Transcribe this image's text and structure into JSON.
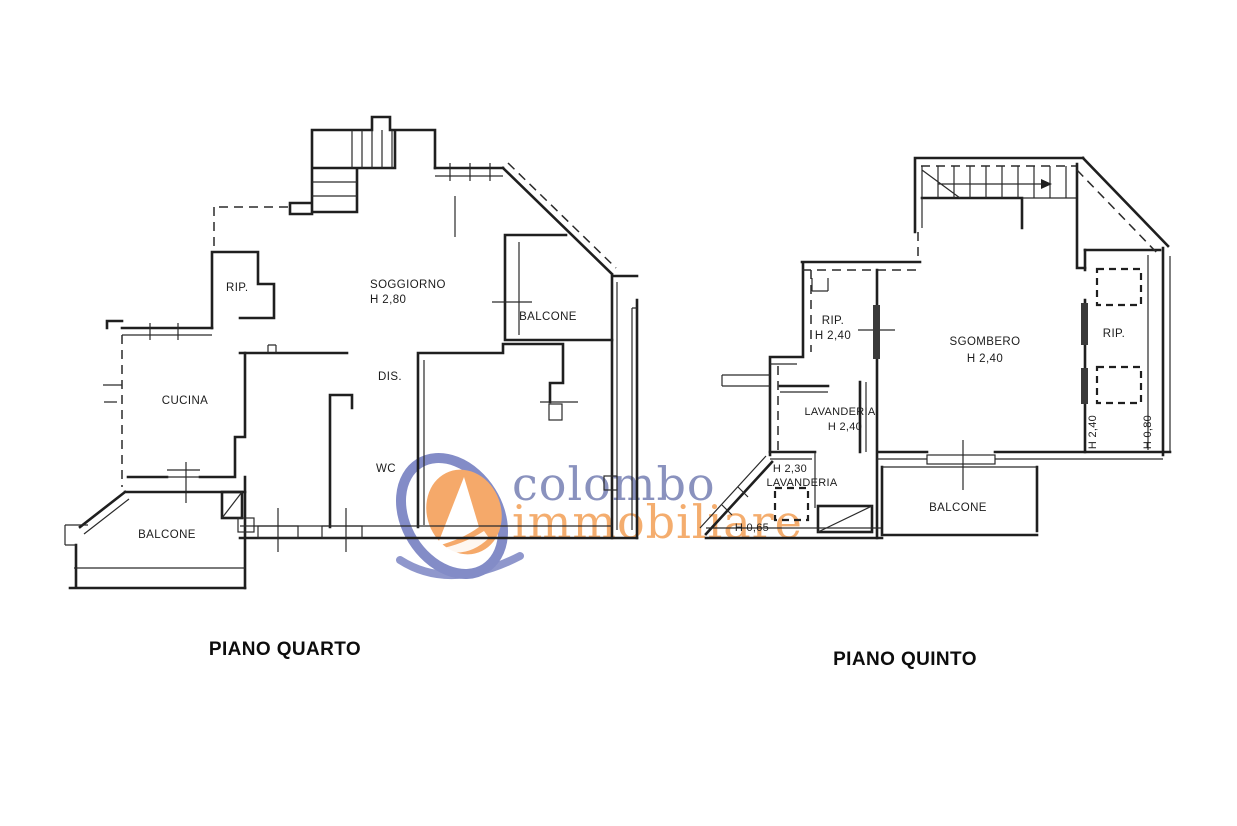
{
  "watermark": {
    "word1": "colombo",
    "word2": "immobiliare",
    "colors": {
      "ring_blue": "#838cc7",
      "text_blue": "#8a92be",
      "ball_orange": "#f5a96a",
      "text_orange": "#f4ad6e"
    }
  },
  "colors": {
    "line": "#1f1f1f",
    "background": "#ffffff"
  },
  "plans": [
    {
      "title": "PIANO QUARTO",
      "labels": {
        "rip": "RIP.",
        "soggiorno": "SOGGIORNO",
        "soggiorno_h": "H 2,80",
        "balcone_right": "BALCONE",
        "cucina": "CUCINA",
        "dis": "DIS.",
        "wc": "WC",
        "balcone_left": "BALCONE"
      }
    },
    {
      "title": "PIANO QUINTO",
      "labels": {
        "rip_left": "RIP.",
        "rip_left_h": "H 2,40",
        "sgombero": "SGOMBERO",
        "sgombero_h": "H 2,40",
        "rip_right": "RIP.",
        "lavanderia": "LAVANDERIA",
        "lavanderia_h": "H 2,40",
        "lavanderia2_h": "H 2,30",
        "lavanderia2": "LAVANDERIA",
        "h065": "H 0,65",
        "balcone": "BALCONE",
        "h240_vertical": "H 2,40",
        "h080_vertical": "H 0,80"
      }
    }
  ]
}
